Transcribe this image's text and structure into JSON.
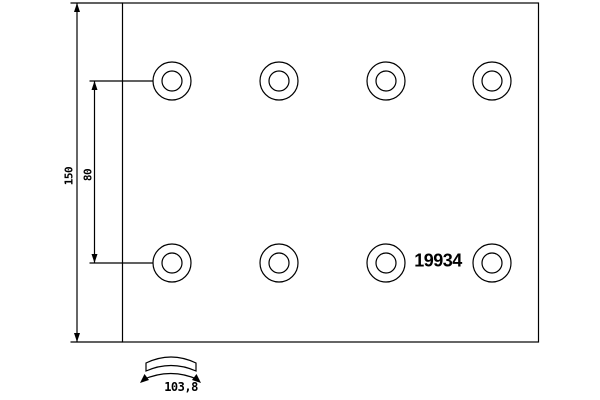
{
  "drawing": {
    "part_number": "19934",
    "labels": {
      "height": "150",
      "hole_spacing": "80",
      "arc_width": "103,8"
    }
  },
  "holes": {
    "cx": [
      172,
      279,
      386,
      492
    ],
    "cy": [
      81,
      263
    ],
    "outer_r": 19,
    "inner_r": 10
  },
  "colors": {
    "line": "#000000",
    "background": "#ffffff"
  }
}
